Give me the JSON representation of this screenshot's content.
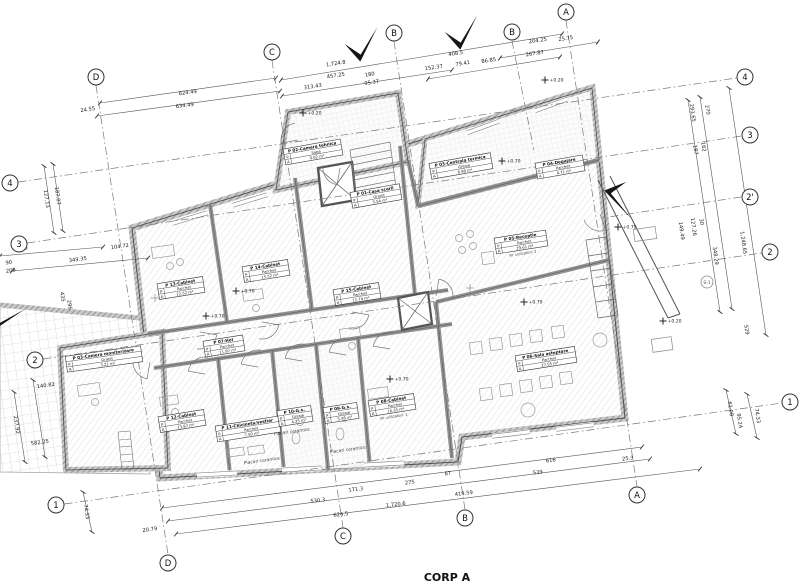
{
  "title": {
    "label": "CORP A"
  },
  "colors": {
    "ink": "#333333",
    "wall": "#8a8a8a",
    "paper": "#ffffff",
    "arrow": "#151515"
  },
  "grid": {
    "top": [
      {
        "label": "D",
        "x": 96,
        "y": 77
      },
      {
        "label": "C",
        "x": 272,
        "y": 52
      },
      {
        "label": "B",
        "x": 394,
        "y": 33
      },
      {
        "label": "B",
        "x": 512,
        "y": 32
      },
      {
        "label": "A",
        "x": 566,
        "y": 12
      }
    ],
    "bottom": [
      {
        "label": "D",
        "x": 168,
        "y": 563
      },
      {
        "label": "C",
        "x": 343,
        "y": 536
      },
      {
        "label": "B",
        "x": 465,
        "y": 518
      },
      {
        "label": "A",
        "x": 637,
        "y": 495
      }
    ],
    "left": [
      {
        "label": "4",
        "x": 10,
        "y": 183
      },
      {
        "label": "3",
        "x": 19,
        "y": 244
      },
      {
        "label": "2",
        "x": 35,
        "y": 360
      },
      {
        "label": "1",
        "x": 56,
        "y": 505
      }
    ],
    "right": [
      {
        "label": "4",
        "x": 745,
        "y": 77
      },
      {
        "label": "3",
        "x": 750,
        "y": 135
      },
      {
        "label": "2'",
        "x": 750,
        "y": 197
      },
      {
        "label": "2",
        "x": 770,
        "y": 252
      },
      {
        "label": "1",
        "x": 790,
        "y": 402
      }
    ],
    "stubs": [
      [
        512,
        41,
        534,
        150
      ],
      [
        741,
        197,
        602,
        218
      ]
    ]
  },
  "section_marker": {
    "label": "S-1",
    "x": 707,
    "y": 282
  },
  "rooms": [
    {
      "name": "P 02-Camera tehnica",
      "finish": "Sapa",
      "area": "9.02 m²",
      "x": 313,
      "y": 152,
      "angle": -10,
      "w": 58
    },
    {
      "name": "P 01-Casa scarii",
      "finish": "Granit",
      "area": "5.54 m²",
      "x": 376,
      "y": 196,
      "angle": -10,
      "w": 50
    },
    {
      "name": "P 03-Centrala termica",
      "finish": "Gresie",
      "area": "6.98 m²",
      "x": 461,
      "y": 166,
      "angle": -10,
      "w": 62
    },
    {
      "name": "P 04-Degajare",
      "finish": "Parchet",
      "area": "4.71 m²",
      "x": 560,
      "y": 167,
      "angle": -10,
      "w": 48
    },
    {
      "name": "P 05-Receptie",
      "finish": "Parchet",
      "area": "29.61 m²",
      "note": "Nr. utilizatori: 2",
      "x": 521,
      "y": 242,
      "angle": -9,
      "w": 52
    },
    {
      "name": "P 06-Sala asteptare",
      "finish": "Parchet",
      "area": "27.55 m²",
      "x": 546,
      "y": 359,
      "angle": -9,
      "w": 60
    },
    {
      "name": "P 13-Cabinet",
      "finish": "Parchet",
      "area": "12.52 m²",
      "x": 181,
      "y": 288,
      "angle": -9,
      "w": 46
    },
    {
      "name": "P 14-Cabinet",
      "finish": "Parchet",
      "area": "15.52 m²",
      "x": 266,
      "y": 271,
      "angle": -9,
      "w": 46
    },
    {
      "name": "P 15-Cabinet",
      "finish": "Parchet",
      "area": "12.74 m²",
      "x": 357,
      "y": 294,
      "angle": -9,
      "w": 46
    },
    {
      "name": "P 07-Hol",
      "finish": "Parchet",
      "area": "11.97 m²",
      "x": 224,
      "y": 346,
      "angle": -9,
      "w": 40
    },
    {
      "name": "P 03-Camera monitorizare",
      "finish": "Granit",
      "area": "3.21 m²",
      "x": 104,
      "y": 359,
      "angle": -8,
      "w": 76
    },
    {
      "name": "P 12-Cabinet",
      "finish": "Parchet",
      "area": "13.87 m²",
      "x": 182,
      "y": 421,
      "angle": -9,
      "w": 46
    },
    {
      "name": "P 11-Chicineta/vestiar",
      "finish": "Parchet",
      "area": "7.50 m²",
      "x": 248,
      "y": 429,
      "angle": -9,
      "w": 64
    },
    {
      "name": "P 10-G.s.",
      "finish": "Gresie",
      "area": "4.25 m²",
      "x": 295,
      "y": 416,
      "angle": -9,
      "w": 34
    },
    {
      "name": "P 09-G.s.",
      "finish": "Gresie",
      "area": "5.38 m²",
      "x": 341,
      "y": 413,
      "angle": -9,
      "w": 34
    },
    {
      "name": "P 08-Cabinet",
      "finish": "Parchet",
      "area": "16.35 m²",
      "note": "Nr. utilizatori: 1",
      "x": 392,
      "y": 405,
      "angle": -9,
      "w": 46
    }
  ],
  "dim_texts": [
    {
      "text": "624.49",
      "x": 188,
      "y": 94,
      "r": -8
    },
    {
      "text": "634.49",
      "x": 185,
      "y": 107,
      "r": -8
    },
    {
      "text": "24.55",
      "x": 88,
      "y": 111,
      "r": -8
    },
    {
      "text": "1,724.8",
      "x": 336,
      "y": 65,
      "r": -9
    },
    {
      "text": "457.25",
      "x": 336,
      "y": 77,
      "r": -9
    },
    {
      "text": "313.43",
      "x": 313,
      "y": 88,
      "r": -9
    },
    {
      "text": "180",
      "x": 370,
      "y": 76,
      "r": -9
    },
    {
      "text": "95.37",
      "x": 372,
      "y": 84,
      "r": -9
    },
    {
      "text": "152.37",
      "x": 434,
      "y": 69,
      "r": -9
    },
    {
      "text": "79.41",
      "x": 463,
      "y": 65,
      "r": -9
    },
    {
      "text": "86.85",
      "x": 489,
      "y": 62,
      "r": -9
    },
    {
      "text": "408.5",
      "x": 456,
      "y": 55,
      "r": -9
    },
    {
      "text": "267.87",
      "x": 535,
      "y": 55,
      "r": -9
    },
    {
      "text": "204.25",
      "x": 538,
      "y": 42,
      "r": -9
    },
    {
      "text": "25.75",
      "x": 566,
      "y": 40,
      "r": -9
    },
    {
      "text": "127.13",
      "x": 45,
      "y": 199,
      "r": 82
    },
    {
      "text": "187.07",
      "x": 56,
      "y": 196,
      "r": 82
    },
    {
      "text": "500",
      "x": 23,
      "y": 250,
      "r": -8
    },
    {
      "text": "349.35",
      "x": 78,
      "y": 261,
      "r": -8
    },
    {
      "text": "104.72",
      "x": 120,
      "y": 248,
      "r": -8
    },
    {
      "text": "90",
      "x": 9,
      "y": 264,
      "r": -8
    },
    {
      "text": "208",
      "x": 11,
      "y": 272,
      "r": -8
    },
    {
      "text": "435",
      "x": 61,
      "y": 297,
      "r": 82
    },
    {
      "text": "296",
      "x": 68,
      "y": 305,
      "r": 82
    },
    {
      "text": "582.25",
      "x": 40,
      "y": 444,
      "r": -8
    },
    {
      "text": "140.82",
      "x": 46,
      "y": 387,
      "r": -8
    },
    {
      "text": "237.92",
      "x": 15,
      "y": 425,
      "r": 82
    },
    {
      "text": "74.33",
      "x": 85,
      "y": 512,
      "r": 82
    },
    {
      "text": "20.79",
      "x": 150,
      "y": 531,
      "r": -8
    },
    {
      "text": "530.3",
      "x": 318,
      "y": 502,
      "r": -7
    },
    {
      "text": "624.5",
      "x": 341,
      "y": 516,
      "r": -7
    },
    {
      "text": "1,720.6",
      "x": 396,
      "y": 506,
      "r": -7
    },
    {
      "text": "171.3",
      "x": 356,
      "y": 491,
      "r": -7
    },
    {
      "text": "275",
      "x": 410,
      "y": 484,
      "r": -7
    },
    {
      "text": "419.59",
      "x": 464,
      "y": 495,
      "r": -7
    },
    {
      "text": "87",
      "x": 448,
      "y": 475,
      "r": -7
    },
    {
      "text": "616",
      "x": 551,
      "y": 462,
      "r": -7
    },
    {
      "text": "25.3",
      "x": 628,
      "y": 460,
      "r": -7
    },
    {
      "text": "539",
      "x": 538,
      "y": 474,
      "r": -7
    },
    {
      "text": "293.65",
      "x": 691,
      "y": 113,
      "r": 82
    },
    {
      "text": "270",
      "x": 706,
      "y": 110,
      "r": 82
    },
    {
      "text": "1,248.65",
      "x": 742,
      "y": 243,
      "r": 82
    },
    {
      "text": "348.29",
      "x": 714,
      "y": 256,
      "r": 82
    },
    {
      "text": "149.49",
      "x": 680,
      "y": 231,
      "r": 82
    },
    {
      "text": "127.26",
      "x": 692,
      "y": 227,
      "r": 82
    },
    {
      "text": "30",
      "x": 700,
      "y": 222,
      "r": 82
    },
    {
      "text": "529",
      "x": 745,
      "y": 330,
      "r": 82
    },
    {
      "text": "187",
      "x": 694,
      "y": 150,
      "r": 82
    },
    {
      "text": "162",
      "x": 702,
      "y": 147,
      "r": 82
    },
    {
      "text": "61.08",
      "x": 729,
      "y": 409,
      "r": 82
    },
    {
      "text": "95.24",
      "x": 738,
      "y": 421,
      "r": 82
    },
    {
      "text": "74.33",
      "x": 756,
      "y": 416,
      "r": 82
    }
  ],
  "elevation_marks": [
    {
      "text": "+0.20",
      "x": 303,
      "y": 113
    },
    {
      "text": "+0.20",
      "x": 545,
      "y": 80
    },
    {
      "text": "+0.70",
      "x": 502,
      "y": 161
    },
    {
      "text": "+0.70",
      "x": 236,
      "y": 291
    },
    {
      "text": "+0.70",
      "x": 206,
      "y": 316
    },
    {
      "text": "+0.79",
      "x": 618,
      "y": 227
    },
    {
      "text": "+0.20",
      "x": 663,
      "y": 321
    },
    {
      "text": "+0.70",
      "x": 390,
      "y": 379
    },
    {
      "text": "+0.79",
      "x": 524,
      "y": 302
    }
  ],
  "annotations": [
    {
      "text": "Placari ceramice",
      "x": 292,
      "y": 433,
      "r": -8
    },
    {
      "text": "Placari ceramice",
      "x": 348,
      "y": 451,
      "r": -8
    },
    {
      "text": "Placari ceramice",
      "x": 262,
      "y": 462,
      "r": -8
    }
  ]
}
